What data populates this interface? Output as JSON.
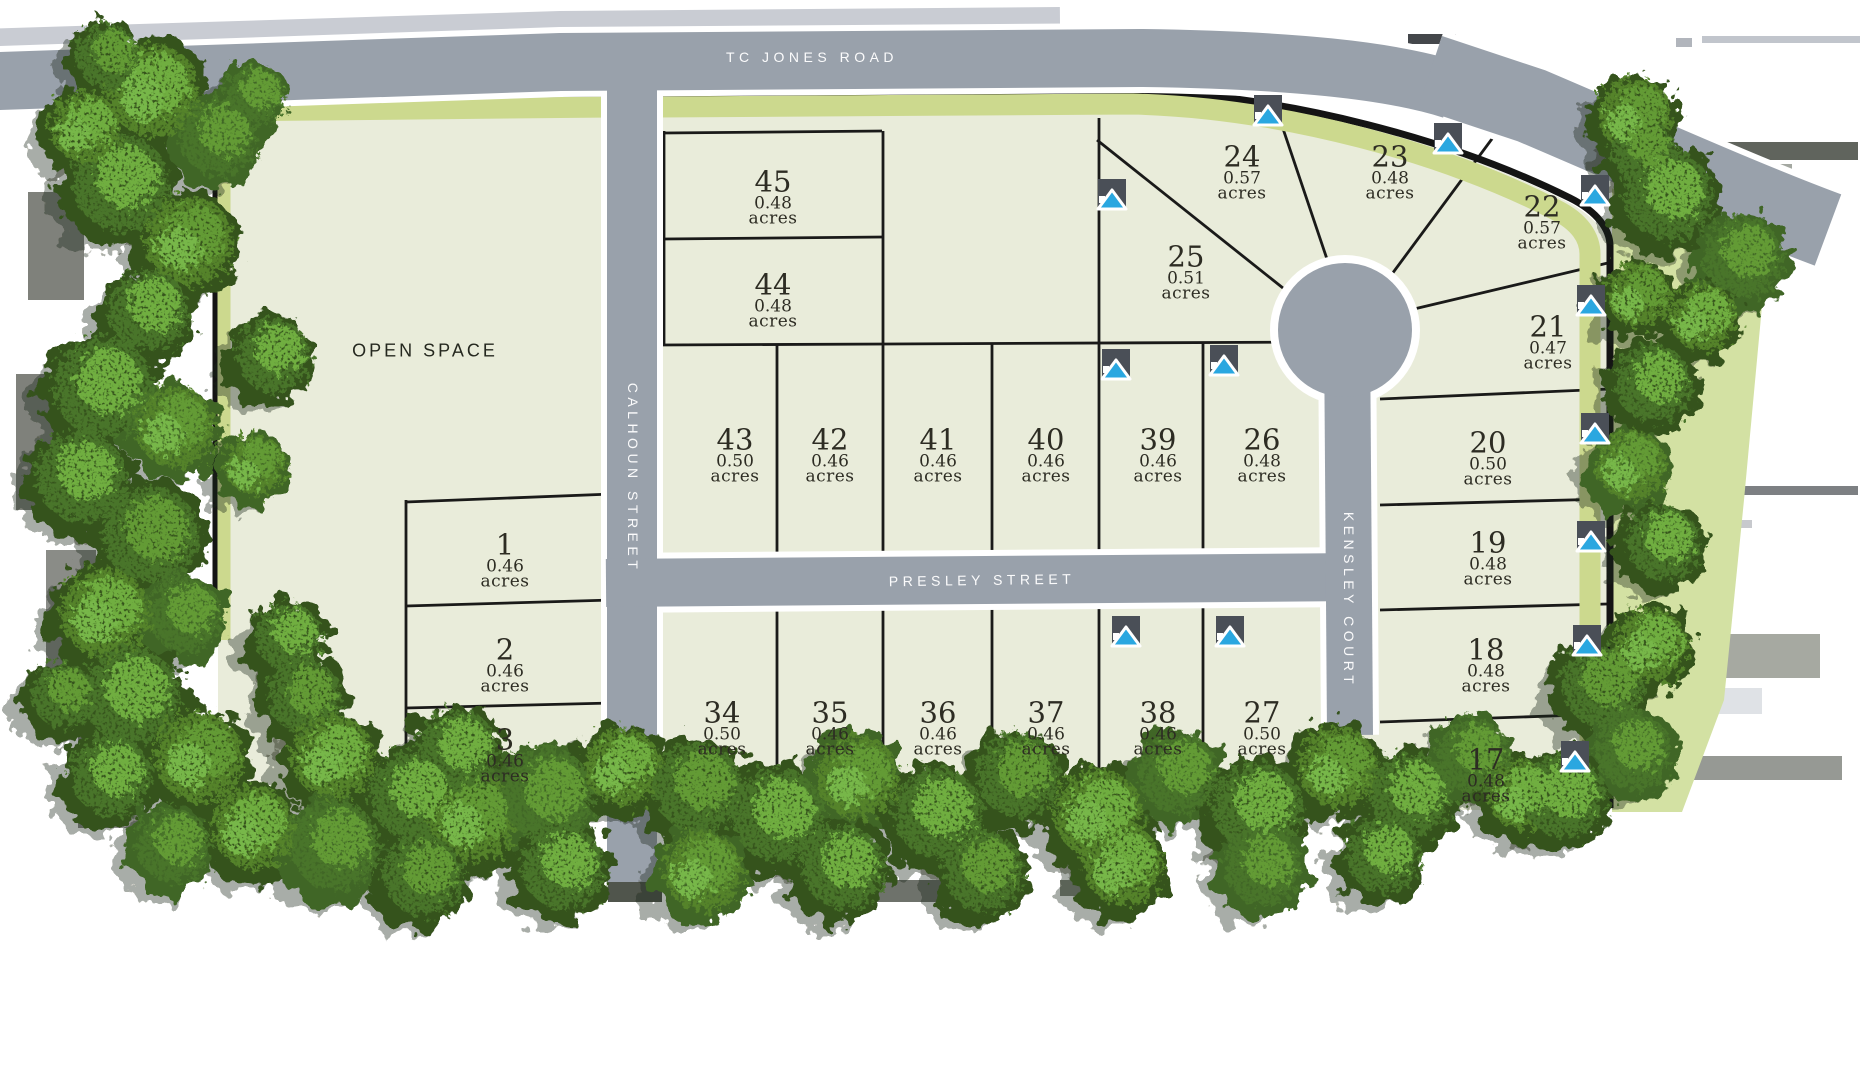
{
  "roads": {
    "tc_jones": "TC JONES ROAD",
    "calhoun": "CALHOUN STREET",
    "presley": "PRESLEY STREET",
    "kensley": "KENSLEY COURT"
  },
  "open_space": "OPEN SPACE",
  "acres_word": "acres",
  "marker_icon": "home-marker-icon",
  "colors": {
    "road_fill": "#99a1ab",
    "road_casing": "#ffffff",
    "parcel_fill": "#e9ecda",
    "verge_lime": "#ccd98e",
    "boundary_black": "#161616",
    "marker_blue": "#2aa7e0",
    "marker_gray": "#4a4f57",
    "tree_green": "#4c7a2c",
    "label_text": "#2d2c23"
  },
  "lots": [
    {
      "num": "1",
      "acres": "0.46",
      "x": 505,
      "y": 560
    },
    {
      "num": "2",
      "acres": "0.46",
      "x": 505,
      "y": 665
    },
    {
      "num": "3",
      "acres": "0.46",
      "x": 505,
      "y": 755
    },
    {
      "num": "45",
      "acres": "0.48",
      "x": 773,
      "y": 197
    },
    {
      "num": "44",
      "acres": "0.48",
      "x": 773,
      "y": 300
    },
    {
      "num": "43",
      "acres": "0.50",
      "x": 735,
      "y": 455
    },
    {
      "num": "42",
      "acres": "0.46",
      "x": 830,
      "y": 455
    },
    {
      "num": "41",
      "acres": "0.46",
      "x": 938,
      "y": 455
    },
    {
      "num": "40",
      "acres": "0.46",
      "x": 1046,
      "y": 455
    },
    {
      "num": "39",
      "acres": "0.46",
      "x": 1158,
      "y": 455
    },
    {
      "num": "26",
      "acres": "0.48",
      "x": 1262,
      "y": 455
    },
    {
      "num": "25",
      "acres": "0.51",
      "x": 1186,
      "y": 272
    },
    {
      "num": "24",
      "acres": "0.57",
      "x": 1242,
      "y": 172
    },
    {
      "num": "23",
      "acres": "0.48",
      "x": 1390,
      "y": 172
    },
    {
      "num": "22",
      "acres": "0.57",
      "x": 1542,
      "y": 222
    },
    {
      "num": "21",
      "acres": "0.47",
      "x": 1548,
      "y": 342
    },
    {
      "num": "20",
      "acres": "0.50",
      "x": 1488,
      "y": 458
    },
    {
      "num": "19",
      "acres": "0.48",
      "x": 1488,
      "y": 558
    },
    {
      "num": "18",
      "acres": "0.48",
      "x": 1486,
      "y": 665
    },
    {
      "num": "17",
      "acres": "0.48",
      "x": 1486,
      "y": 775
    },
    {
      "num": "34",
      "acres": "0.50",
      "x": 722,
      "y": 728
    },
    {
      "num": "35",
      "acres": "0.46",
      "x": 830,
      "y": 728
    },
    {
      "num": "36",
      "acres": "0.46",
      "x": 938,
      "y": 728
    },
    {
      "num": "37",
      "acres": "0.46",
      "x": 1046,
      "y": 728
    },
    {
      "num": "38",
      "acres": "0.46",
      "x": 1158,
      "y": 728
    },
    {
      "num": "27",
      "acres": "0.50",
      "x": 1262,
      "y": 728
    }
  ],
  "markers": [
    {
      "lot": "24",
      "x": 1268,
      "y": 112
    },
    {
      "lot": "25",
      "x": 1112,
      "y": 196
    },
    {
      "lot": "23",
      "x": 1448,
      "y": 140
    },
    {
      "lot": "22",
      "x": 1595,
      "y": 192
    },
    {
      "lot": "21",
      "x": 1591,
      "y": 302
    },
    {
      "lot": "39",
      "x": 1116,
      "y": 366
    },
    {
      "lot": "26",
      "x": 1224,
      "y": 362
    },
    {
      "lot": "20",
      "x": 1595,
      "y": 430
    },
    {
      "lot": "19",
      "x": 1591,
      "y": 538
    },
    {
      "lot": "18",
      "x": 1587,
      "y": 642
    },
    {
      "lot": "17",
      "x": 1575,
      "y": 758
    },
    {
      "lot": "38",
      "x": 1126,
      "y": 633
    },
    {
      "lot": "27",
      "x": 1230,
      "y": 633
    }
  ]
}
